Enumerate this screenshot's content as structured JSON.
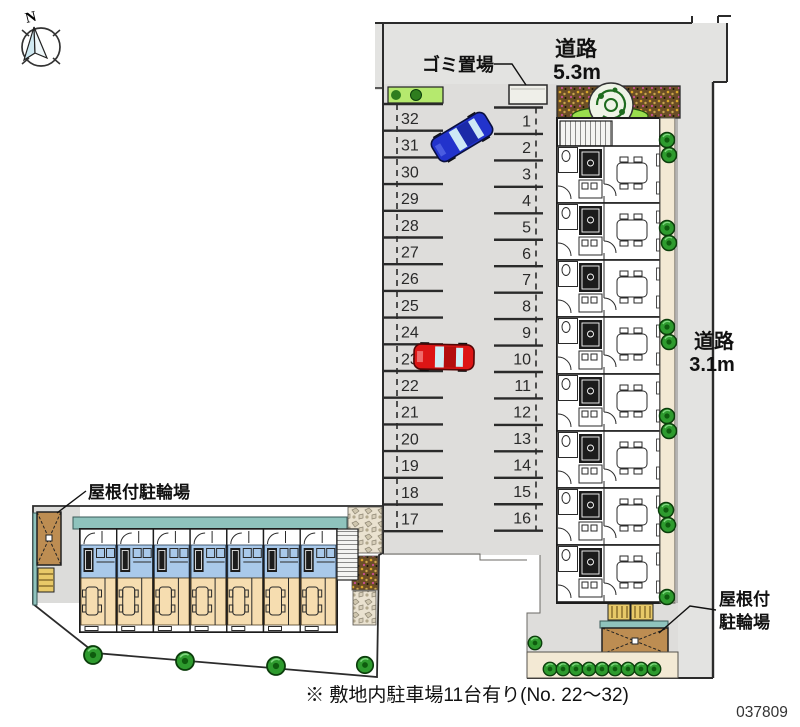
{
  "compass": {
    "north_label": "N"
  },
  "roads": {
    "top": {
      "name": "道路",
      "width": "5.3m"
    },
    "right": {
      "name": "道路",
      "width": "3.1m"
    }
  },
  "labels": {
    "garbage": "ゴミ置場",
    "bike_parking_left": "屋根付駐輪場",
    "bike_parking_right_line1": "屋根付",
    "bike_parking_right_line2": "駐輪場"
  },
  "parking": {
    "left_stalls": [
      "32",
      "31",
      "30",
      "29",
      "28",
      "27",
      "26",
      "25",
      "24",
      "23",
      "22",
      "21",
      "20",
      "19",
      "18",
      "17"
    ],
    "right_stalls": [
      "1",
      "2",
      "3",
      "4",
      "5",
      "6",
      "7",
      "8",
      "9",
      "10",
      "11",
      "12",
      "13",
      "14",
      "15",
      "16"
    ]
  },
  "cars": [
    {
      "color_name": "blue",
      "stall": "31"
    },
    {
      "color_name": "red",
      "stall": "23"
    }
  ],
  "footer": {
    "note": "※ 敷地内駐車場11台有り(No. 22～32)",
    "plan_number": "037809"
  },
  "colors": {
    "road": "#e3e3e1",
    "asphalt": "#dedddb",
    "boundary": "#2b2b2b",
    "walkway": "#f3e9d4",
    "room-tan": "#f6ddb0",
    "room-blue": "#a9c9ea",
    "balcony-teal": "#8fc3bd",
    "shelter-brown": "#bd8d52",
    "rack-yellow": "#e8c968",
    "grass-green": "#b5e96e",
    "tree-green": "#2e9b2e",
    "car-blue": "#2233cc",
    "car-red": "#dd1515"
  }
}
